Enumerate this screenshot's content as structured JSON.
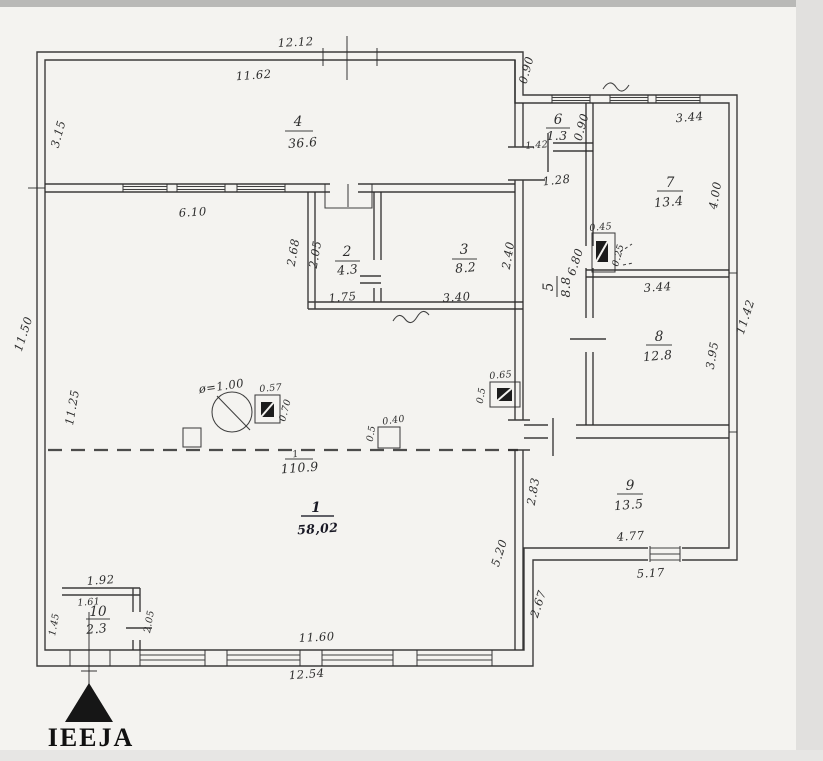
{
  "drawing": {
    "kind": "hand-drawn building floor plan (inventory sketch)",
    "ink_color": "#2c2c2c",
    "paper_color": "#f4f3f0"
  },
  "entrance": {
    "label": "IEEJA"
  },
  "overall": {
    "numerator": "1",
    "denominator": "110.9"
  },
  "rooms": {
    "r1": {
      "no": "1",
      "area": "58,02"
    },
    "r2": {
      "no": "2",
      "area": "4.3"
    },
    "r3": {
      "no": "3",
      "area": "8.2"
    },
    "r4": {
      "no": "4",
      "area": "36.6"
    },
    "r5": {
      "no": "5",
      "area": "8.8"
    },
    "r6": {
      "no": "6",
      "area": "1.3"
    },
    "r7": {
      "no": "7",
      "area": "13.4"
    },
    "r8": {
      "no": "8",
      "area": "12.8"
    },
    "r9": {
      "no": "9",
      "area": "13.5"
    },
    "r10": {
      "no": "10",
      "area": "2.3"
    }
  },
  "dims": {
    "top_outer": "12.12",
    "top_inner": "11.62",
    "room4_left": "3.15",
    "left_outer": "11.50",
    "left_inner": "11.25",
    "room4_bottom": "6.10",
    "room2_left_outer": "2.68",
    "room2_left_inner": "2.05",
    "room2_bottom": "1.75",
    "room3_bottom": "3.40",
    "room3_right": "2.40",
    "wing_connector": "0.90",
    "room6_bottom": "1.42",
    "room6_right": "0.90",
    "hall_width": "1.28",
    "room7_top": "3.44",
    "room7_right": "4.00",
    "hall_height": "6.80",
    "room8_top": "3.44",
    "room8_right": "3.95",
    "right_outer": "11.42",
    "room9_left": "2.83",
    "room9_bottom": "4.77",
    "room9_bottom_outer": "5.17",
    "room1_right": "5.20",
    "room1_right_lower": "2.67",
    "room10_top": "1.92",
    "room10_top_inner": "1.61",
    "room10_left": "1.45",
    "room10_right": "2.05",
    "bottom_inner": "11.60",
    "bottom_outer": "12.54"
  },
  "fixtures": {
    "well_diameter": "ø=1.00",
    "stove_main_w": "0.57",
    "stove_main_h": "0.70",
    "chimney_w": "0.40",
    "chimney_h": "0.5",
    "stove_hall_w": "0.65",
    "stove_hall_h": "0.5",
    "stove_room7_w": "0.45",
    "stove_room7_d": "0.25"
  }
}
